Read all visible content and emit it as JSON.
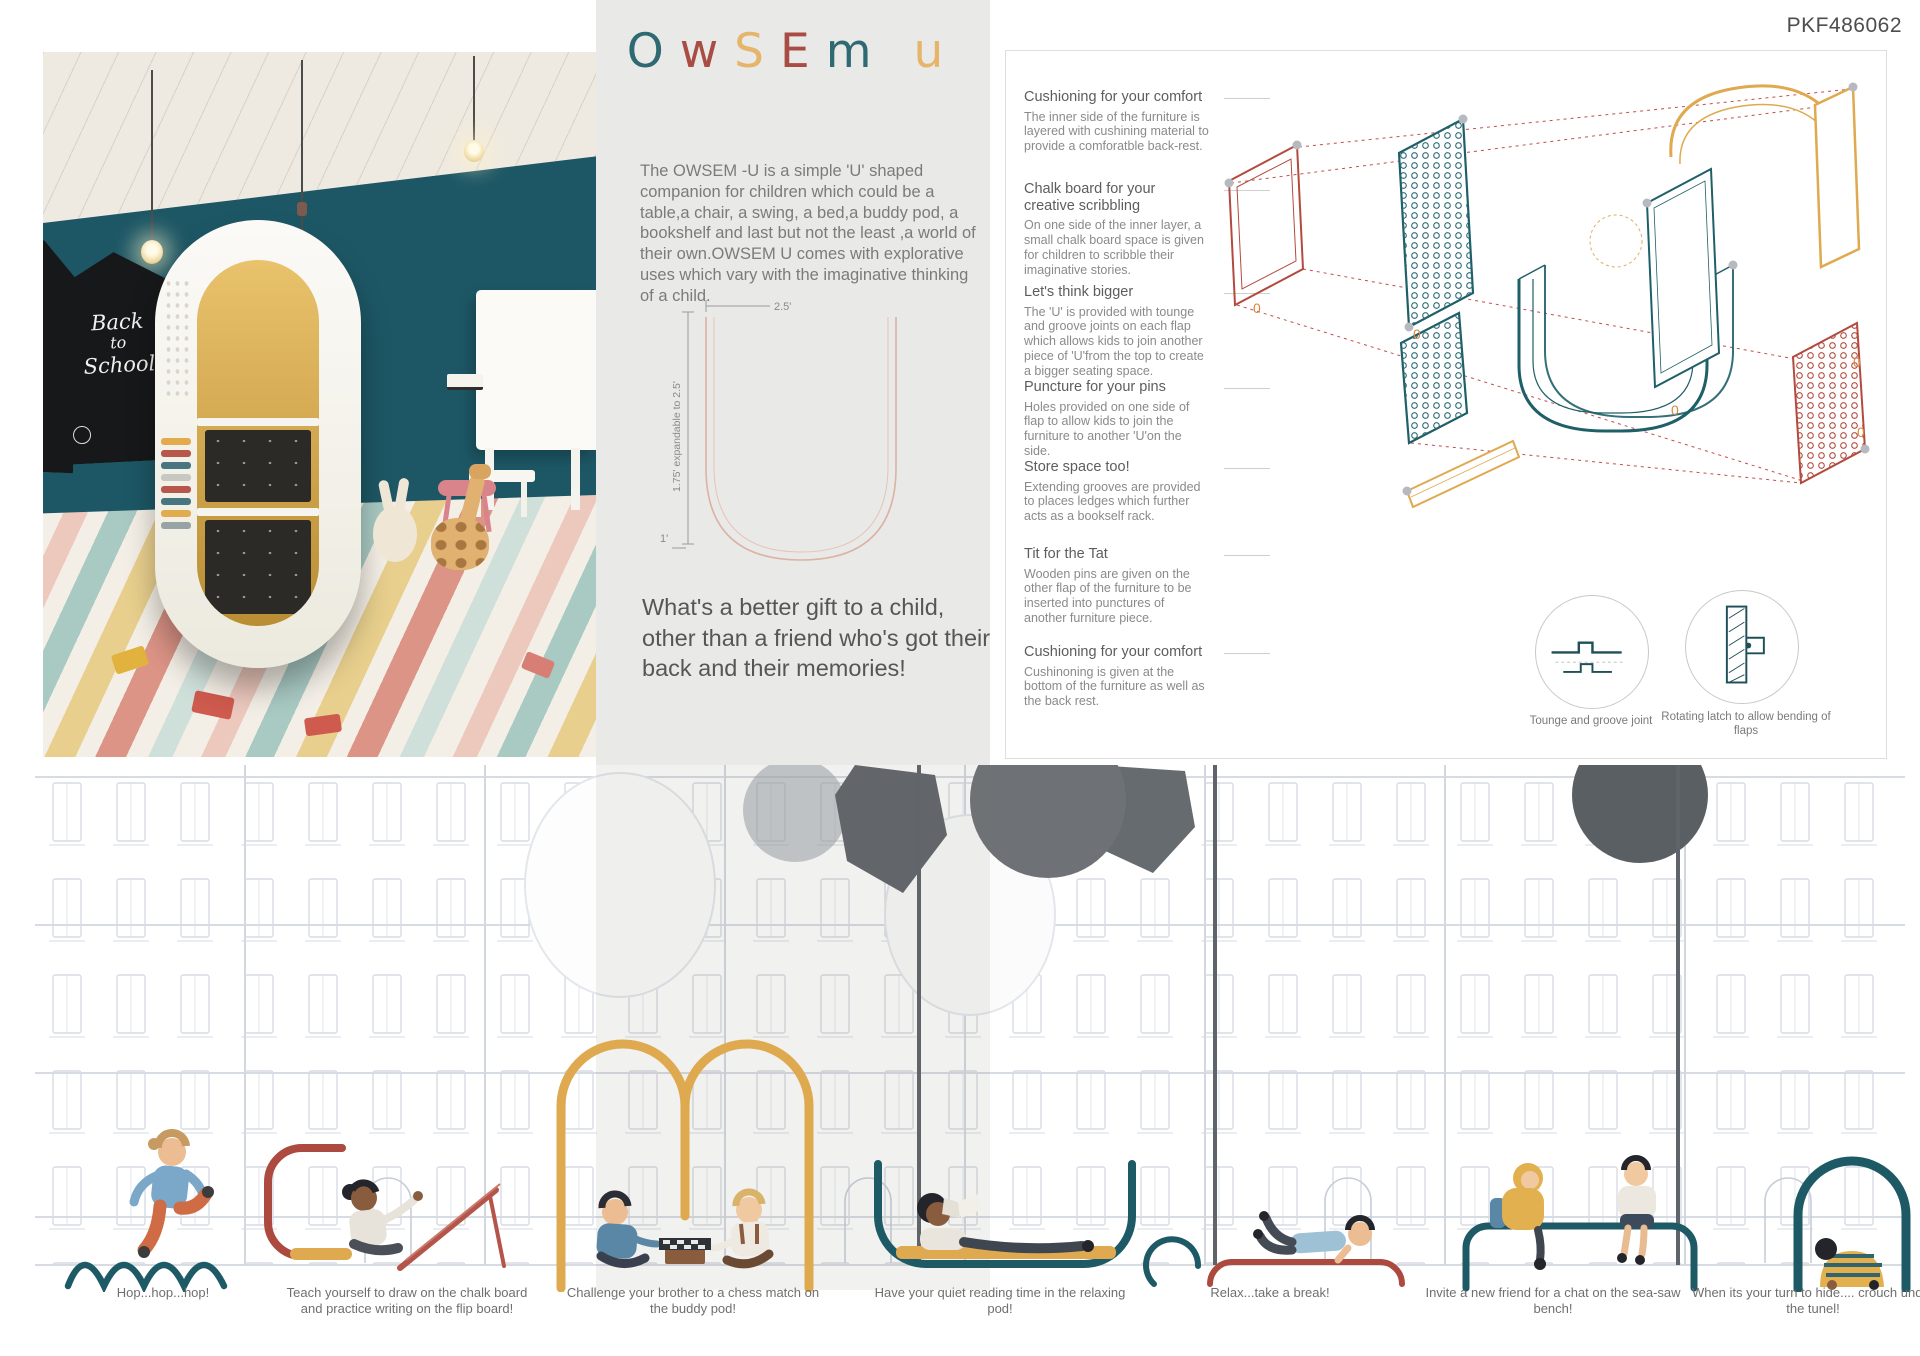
{
  "header": {
    "code": "PKF486062"
  },
  "title": {
    "text": "OwSEm u",
    "letters": [
      {
        "char": "O",
        "color": "#2f6a72"
      },
      {
        "char": "w",
        "color": "#a84c44"
      },
      {
        "char": "S",
        "color": "#e6b56c"
      },
      {
        "char": "E",
        "color": "#a84c44"
      },
      {
        "char": "m",
        "color": "#2f6a72"
      },
      {
        "char": "u",
        "color": "#e6b56c"
      }
    ]
  },
  "photo": {
    "chalkboard_lines": {
      "l1": "Back",
      "l2": "to",
      "l3": "School"
    }
  },
  "intro": {
    "description": "The OWSEM -U is a simple 'U' shaped companion for children which could be a table,a chair, a swing, a bed,a buddy pod, a bookshelf and last but not the least ,a world of their own.OWSEM U comes with explorative uses which vary with the imaginative thinking of a child.",
    "tagline": "What's a better gift to a child, other than a friend who's got their back and their memories!"
  },
  "dimensions": {
    "width": "2.5'",
    "height": "1.75' expandable to 2.5'",
    "base": "1'"
  },
  "features": [
    {
      "heading": "Cushioning for your comfort",
      "body": "The inner side of the furniture is layered with cushining material to provide a comforatble back-rest."
    },
    {
      "heading": "Chalk board for your creative scribbling",
      "body": "On one side of the inner layer, a small chalk board space is given for children to scribble their imaginative stories."
    },
    {
      "heading": "Let's think bigger",
      "body": "The 'U' is provided with tounge and groove joints on each flap which allows kids to join another piece of 'U'from the top to create a bigger seating space."
    },
    {
      "heading": "Puncture for your pins",
      "body": "Holes provided on one side of flap to allow kids to join the furniture to another 'U'on the side."
    },
    {
      "heading": "Store space too!",
      "body": "Extending grooves are provided to places ledges which further acts as a bookself rack."
    },
    {
      "heading": "Tit for the Tat",
      "body": "Wooden pins are given on the other flap of the furniture to be inserted into punctures of another furniture piece."
    },
    {
      "heading": "Cushioning for your comfort",
      "body": "Cushinoning is given at the bottom of the furniture as well as the back rest."
    }
  ],
  "exploded": {
    "marker": "0"
  },
  "details": [
    {
      "label": "Tounge and groove joint"
    },
    {
      "label": "Rotating latch to allow bending of flaps"
    }
  ],
  "scenes": [
    {
      "caption": "Hop...hop...hop!"
    },
    {
      "caption": "Teach yourself to draw on the chalk board and practice writing on the flip board!"
    },
    {
      "caption": "Challenge your brother to a chess match on the buddy pod!"
    },
    {
      "caption": "Have your quiet reading time in the relaxing pod!"
    },
    {
      "caption": "Relax...take a break!"
    },
    {
      "caption": "Invite a new friend for a chat on the sea-saw bench!"
    },
    {
      "caption": "When its your turn to hide.... crouch under the tunel!"
    }
  ],
  "colors": {
    "teal": "#1d5a66",
    "maroon": "#ad4a3f",
    "yellow": "#dfa94f",
    "panel_gray": "#e9e9e7",
    "wall_teal": "#1d5765",
    "text_gray": "#7b7b7b",
    "facade_line": "#d7dce3"
  }
}
